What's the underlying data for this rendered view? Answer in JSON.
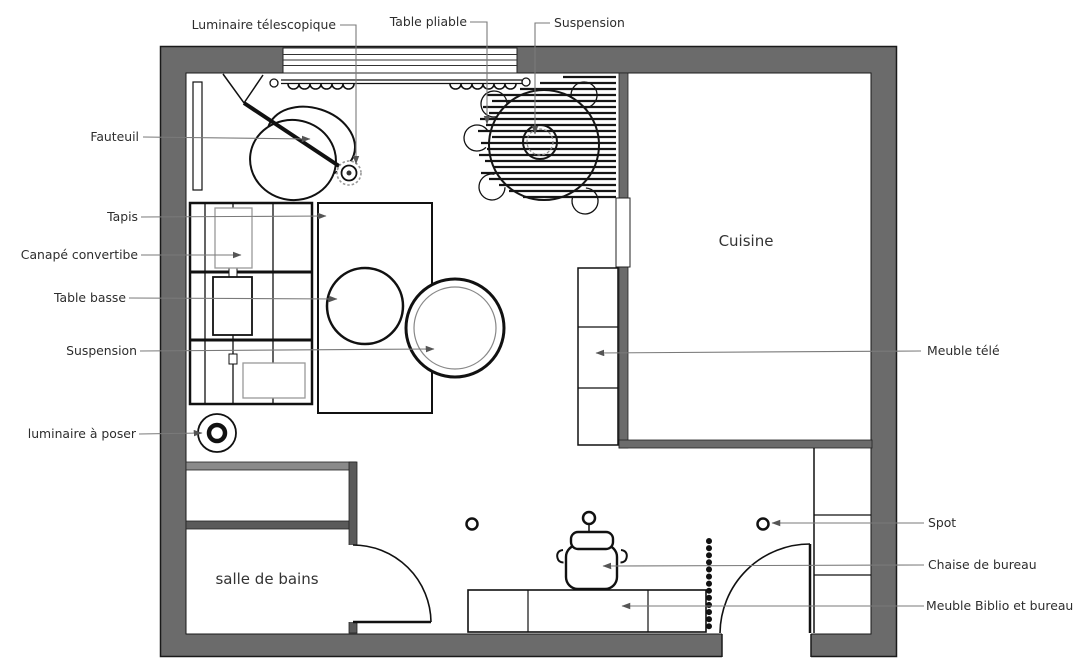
{
  "plan": {
    "callouts": {
      "luminaire_telescopique": "Luminaire télescopique",
      "table_pliable": "Table pliable",
      "suspension_haut": "Suspension",
      "fauteuil": "Fauteuil",
      "tapis": "Tapis",
      "canape_convertible": "Canapé convertibe",
      "table_basse": "Table basse",
      "suspension_gauche": "Suspension",
      "luminaire_a_poser": "luminaire à poser",
      "meuble_tele": "Meuble télé",
      "spot": "Spot",
      "chaise_de_bureau": "Chaise de bureau",
      "meuble_biblio_et_bureau": "Meuble Biblio et bureau"
    },
    "rooms": {
      "cuisine": "Cuisine",
      "salle_de_bains": "salle de bains"
    },
    "colors": {
      "wall": "#6b6b6b",
      "wall_dark": "#5a5a5a",
      "line": "#111111",
      "leader": "#7a7a7a",
      "text": "#2d2d2d",
      "background": "#ffffff"
    }
  }
}
